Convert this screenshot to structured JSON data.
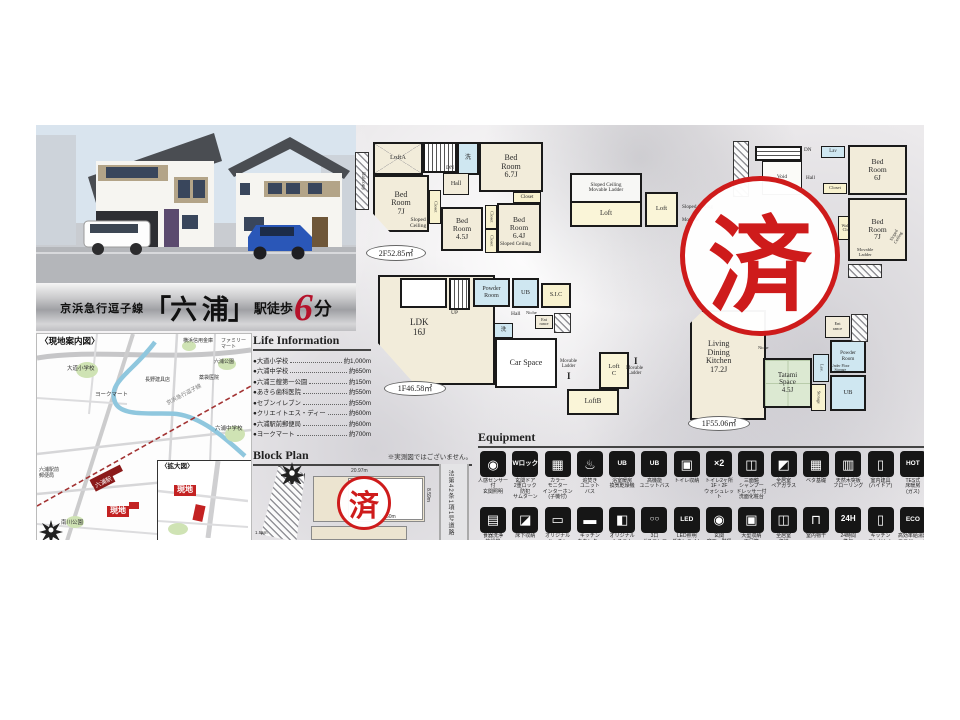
{
  "banner": {
    "line": "京浜急行逗子線",
    "station": "「六 浦」",
    "walk_label": "駅徒歩",
    "minutes": "6",
    "minutes_unit": "分"
  },
  "stamp": {
    "text": "済"
  },
  "map": {
    "title": "〈現地案内図〉",
    "inset_title": "〈拡大図〉",
    "site_label": "現地",
    "station": "六浦駅",
    "rail": "京浜急行逗子線",
    "labels": [
      "大道小学校",
      "ヨークマート",
      "横浜信用金庫",
      "ファミリーマート",
      "六浦公園",
      "薬袋医院",
      "長野建具店",
      "六浦中学校",
      "六浦駅前\n郵便局",
      "南川公園"
    ]
  },
  "life_information": {
    "title": "Life Information",
    "bullet": "●",
    "items": [
      {
        "name": "大道小学校",
        "distance": "約1,000m"
      },
      {
        "name": "六浦中学校",
        "distance": "約650m"
      },
      {
        "name": "六浦三艘第一公園",
        "distance": "約150m"
      },
      {
        "name": "あきら歯科医院",
        "distance": "約550m"
      },
      {
        "name": "セブンイレブン",
        "distance": "約550m"
      },
      {
        "name": "クリエイトエス・ディー",
        "distance": "約600m"
      },
      {
        "name": "六浦駅前郵便局",
        "distance": "約600m"
      },
      {
        "name": "ヨークマート",
        "distance": "約700m"
      }
    ]
  },
  "block_plan": {
    "title": "Block Plan",
    "note": "※実測図ではございません。",
    "road_label": "法第42条1項1号道路",
    "dims": {
      "top": "20.97m",
      "bottom": "14.60m",
      "right": "8.59m",
      "left": "1.55m"
    }
  },
  "fp": {
    "ladder_mark": "I",
    "a_area": "2F52.85㎡",
    "a_balcony": "Balcony",
    "a_loft": "LoftA",
    "a_dn": "DN",
    "a_lav": "洗",
    "a_bed67": "Bed\nRoom\n6.7J",
    "a_hall": "Hall",
    "a_bed7": "Bed\nRoom\n7J",
    "a_sloped1": "Sloped\nCeiling",
    "a_closet": "Closet",
    "a_bed45": "Bed\nRoom\n4.5J",
    "a_bed64": "Bed\nRoom\n6.4J",
    "a_sloped2": "Sloped Ceiling",
    "b_area": "1F46.58㎡",
    "b_ldk": "LDK\n16J",
    "b_up": "UP",
    "b_powder": "Powder\nRoom",
    "b_ub": "UB",
    "b_sic": "S.I.C",
    "b_hall": "Hall",
    "b_niche": "Niche",
    "b_ent": "Ent\nrance",
    "b_lav": "洗",
    "b_car": "Car Space",
    "b_mov": "Movable\nLadder",
    "b_loftb": "LoftB",
    "b_loftc": "Loft\nC",
    "c_sloped1": "Sloped Ceiling\nMovable Ladder",
    "c_loft1": "Loft",
    "c_loft2": "Loft",
    "c_sloped2": "Sloped Ceiling",
    "c_mov": "Movable",
    "d_dn": "DN",
    "d_lav": "Lav",
    "d_bed6": "Bed\nRoom\n6J",
    "d_hall": "Hall",
    "d_void": "Void",
    "d_closet": "Closet",
    "d_wic": "Walk in\nCloset",
    "d_bed7": "Bed\nRoom\n7J",
    "d_mov": "Movable\nLadder",
    "d_sloped": "Sloped\nCeiling",
    "e_area": "1F55.06㎡",
    "e_ldk": "Living\nDining\nKitchen\n17.2J",
    "e_niche": "Niche",
    "e_tatami": "Tatami\nSpace\n4.5J",
    "e_lav": "Lav.",
    "e_powder": "Powder\nRoom",
    "e_ufs": "Under Floor\nStorage",
    "e_ub": "UB",
    "e_storage": "Storage",
    "e_ent": "Ent\nrance"
  },
  "equipment": {
    "title": "Equipment",
    "row1": [
      {
        "g": "◉",
        "l": "人感センサー付\n玄関照明"
      },
      {
        "g": "Wロック",
        "l": "玄関ドア\n2重ロック\n防犯\nサムターン"
      },
      {
        "g": "▦",
        "l": "カラー\nモニター\nインターホン\n(子機付)"
      },
      {
        "g": "♨",
        "l": "追焚き\nユニット\nバス"
      },
      {
        "g": "UB",
        "l": "浴室暖房\n換気乾燥機"
      },
      {
        "g": "UB",
        "l": "高機能\nユニットバス"
      },
      {
        "g": "▣",
        "l": "トイレ収納"
      },
      {
        "g": "×2",
        "l": "トイレ2ヶ所\n1F・2F\nウォシュレット"
      },
      {
        "g": "◫",
        "l": "三面鏡\nシャンプー\nドレッサー付\n洗面化粧台"
      },
      {
        "g": "◩",
        "l": "全居室\nペアガラス"
      },
      {
        "g": "▦",
        "l": "ベタ基礎"
      },
      {
        "g": "▥",
        "l": "天然木突板\nフローリング"
      },
      {
        "g": "▯",
        "l": "室内建具\n(ハイドア)"
      },
      {
        "g": "HOT",
        "l": "TES式\n床暖房\n(ガス)"
      }
    ],
    "row2": [
      {
        "g": "▤",
        "l": "食器洗浄\n乾燥機"
      },
      {
        "g": "◪",
        "l": "床下収納"
      },
      {
        "g": "▭",
        "l": "オリジナル\nキッチン"
      },
      {
        "g": "▬",
        "l": "キッチン\nカウンター"
      },
      {
        "g": "◧",
        "l": "オリジナル\nシステム\nキッチン"
      },
      {
        "g": "○○",
        "l": "3口\nガスコンロ"
      },
      {
        "g": "LED",
        "l": "LED照明\nダウンライト"
      },
      {
        "g": "◉",
        "l": "玄関\n廊下・階段\n手すり付"
      },
      {
        "g": "▣",
        "l": "大型収納\n下足箱\n(鏡付)"
      },
      {
        "g": "◫",
        "l": "全居室\n収納"
      },
      {
        "g": "⊓",
        "l": "室内物干"
      },
      {
        "g": "24H",
        "l": "24時間\n換気"
      },
      {
        "g": "▯",
        "l": "キッチン\nコンセント"
      },
      {
        "g": "ECO",
        "l": "高効率給湯器\nエコジョーズ"
      }
    ]
  }
}
